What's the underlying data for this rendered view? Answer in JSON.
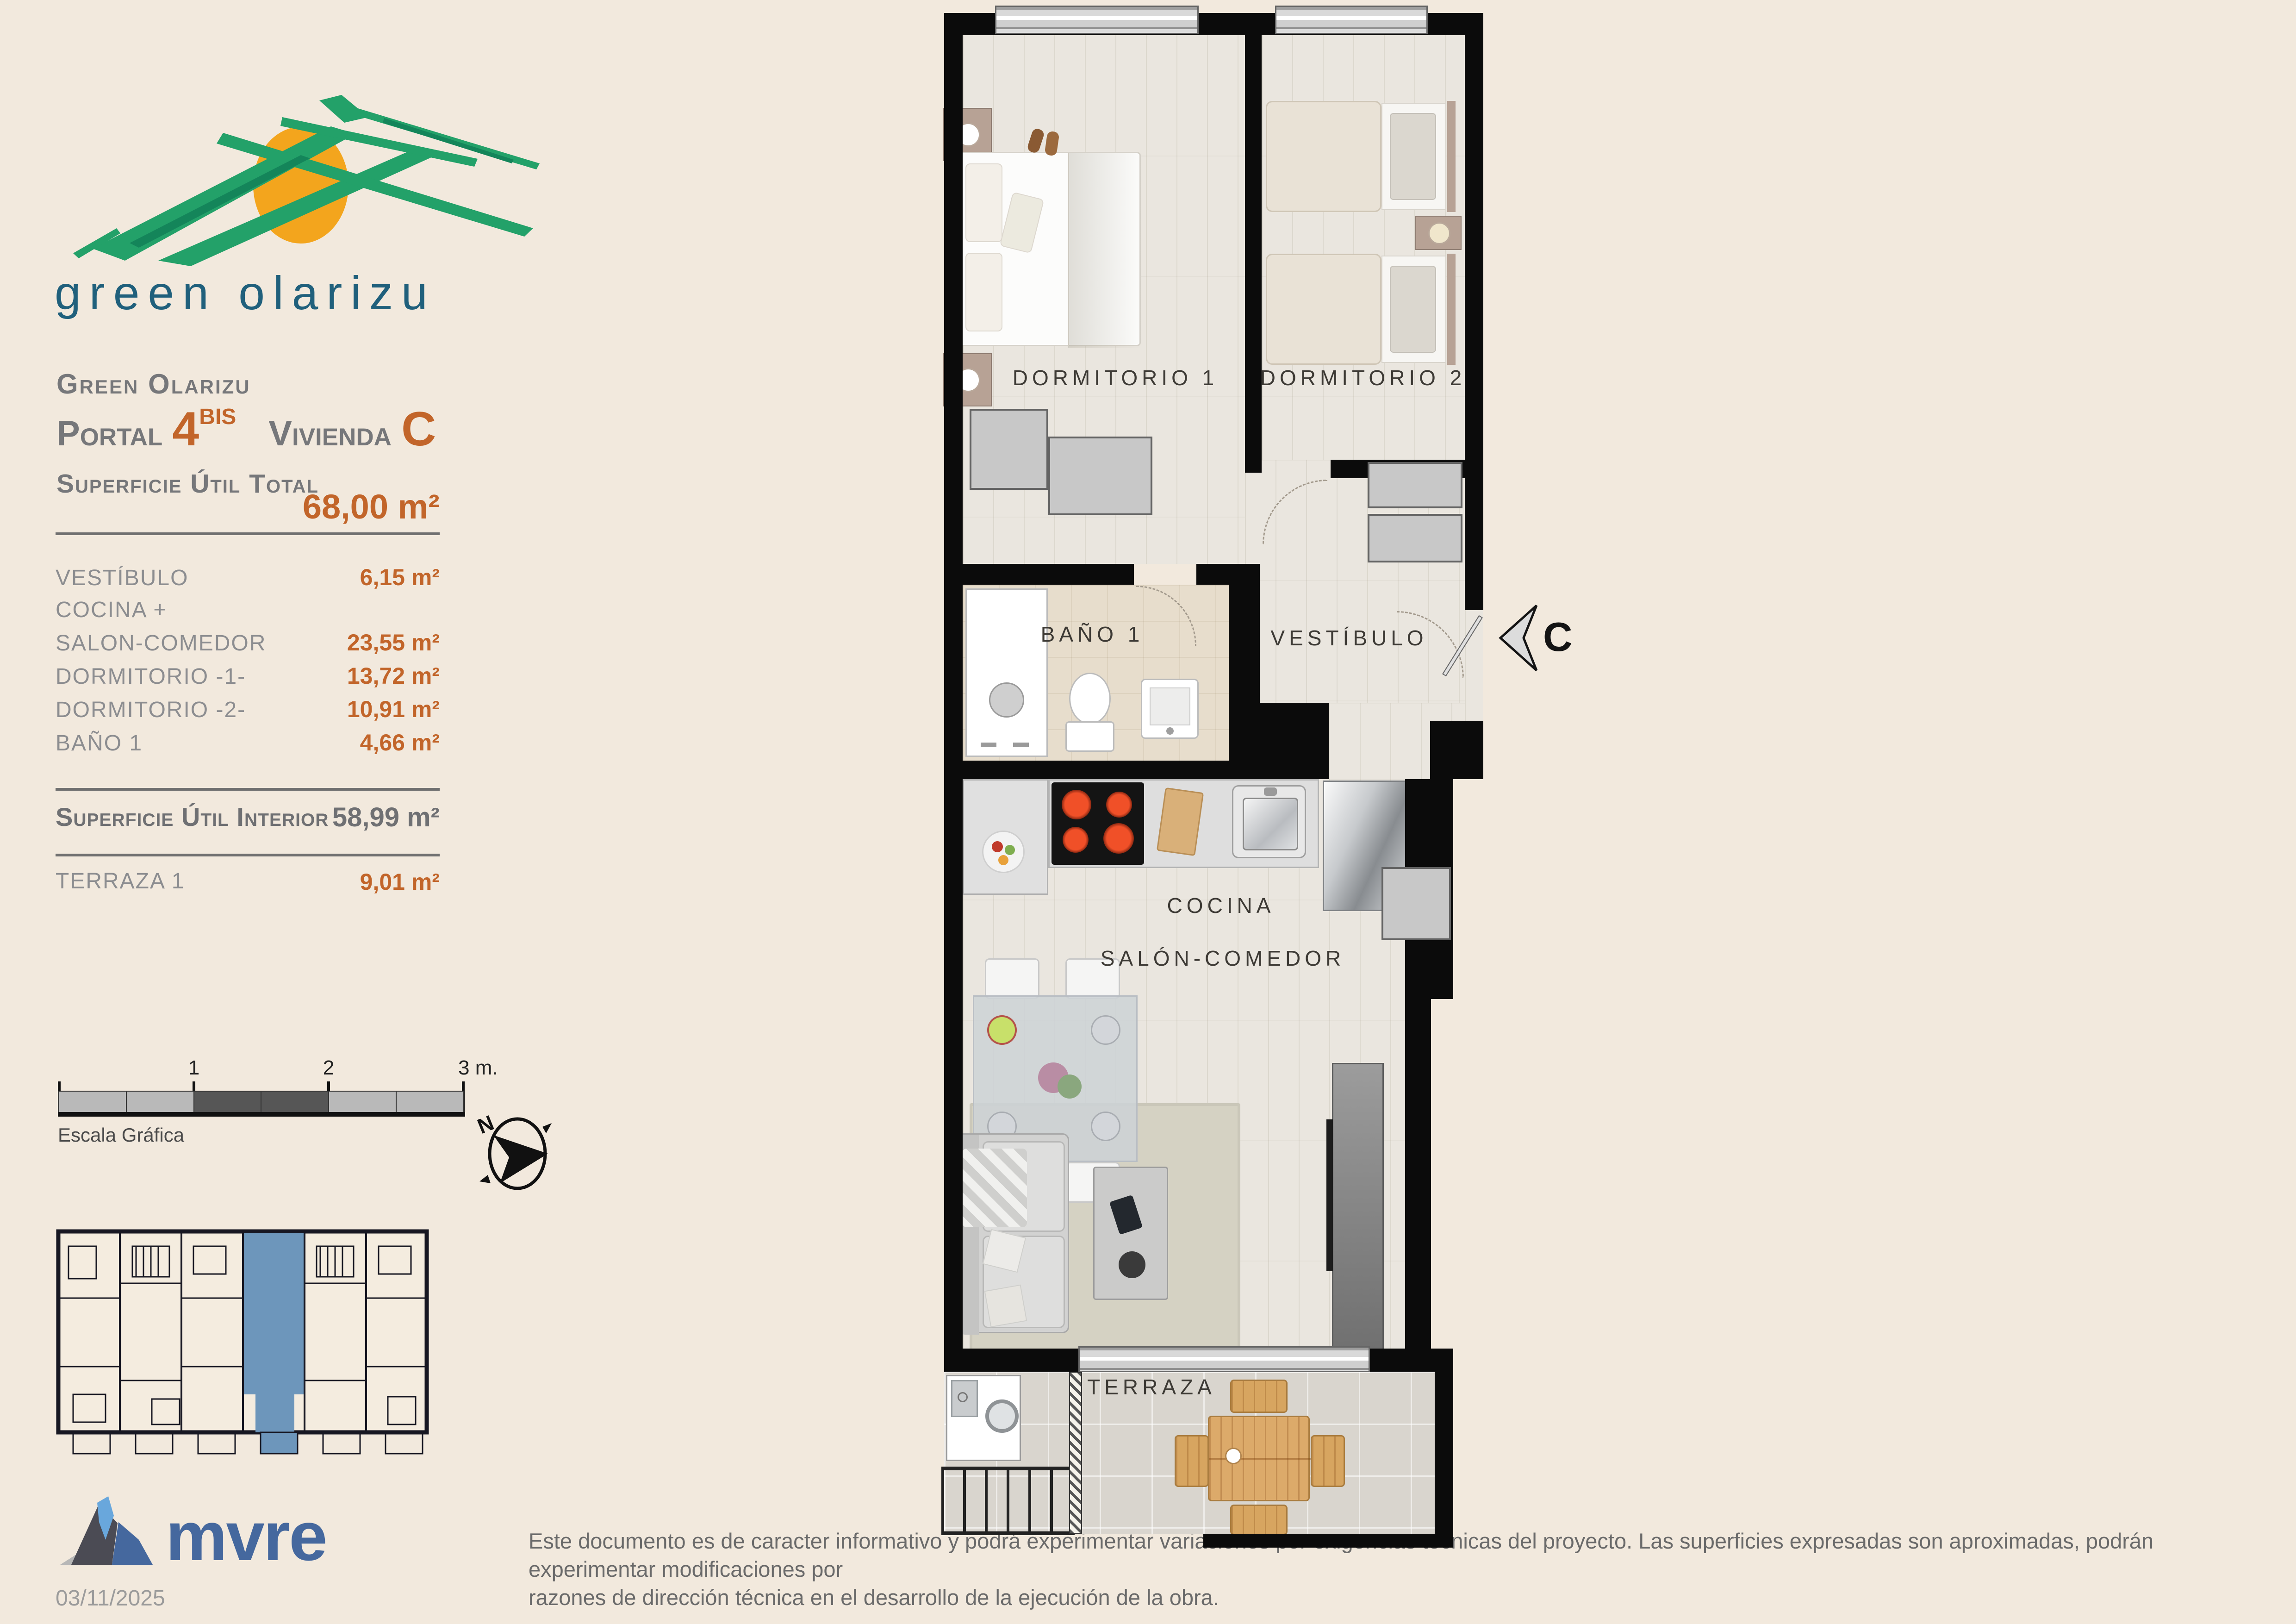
{
  "brand": {
    "logo_text": "green olarizu",
    "company": "mvre",
    "date": "03/11/2025"
  },
  "header": {
    "project": "Green Olarizu",
    "portal_label": "Portal",
    "portal_number": "4",
    "portal_sup": "BIS",
    "vivienda_label": "Vivienda",
    "vivienda_letter": "C"
  },
  "summary": {
    "total_label": "Superficie Útil Total",
    "total_value": "68,00 m²",
    "interior_label": "Superficie Útil Interior",
    "interior_value": "58,99 m²",
    "terrace_label": "TERRAZA 1",
    "terrace_value": "9,01 m²"
  },
  "rooms": [
    {
      "label": "VESTÍBULO",
      "value": "6,15 m²"
    },
    {
      "label": "COCINA +",
      "value": ""
    },
    {
      "label": "SALON-COMEDOR",
      "value": "23,55 m²"
    },
    {
      "label": "DORMITORIO -1-",
      "value": "13,72 m²"
    },
    {
      "label": "DORMITORIO -2-",
      "value": "10,91 m²"
    },
    {
      "label": "BAÑO 1",
      "value": "4,66 m²"
    }
  ],
  "plan": {
    "dorm1": "DORMITORIO 1",
    "dorm2": "DORMITORIO 2",
    "bano": "BAÑO 1",
    "vestibulo": "VESTÍBULO",
    "cocina": "COCINA",
    "salon": "SALÓN-COMEDOR",
    "terraza": "TERRAZA",
    "entrance_letter": "C"
  },
  "scale": {
    "ticks": [
      "1",
      "2",
      "3 m."
    ],
    "caption": "Escala Gráfica"
  },
  "compass": {
    "north": "N"
  },
  "footer": {
    "disclaimer_line1": "Este documento es de caracter informativo y podrá experimentar variaciones por exigencias técnicas del proyecto. Las superficies expresadas son aproximadas, podrán experimentar modificaciones por",
    "disclaimer_line2": "razones de dirección técnica en el desarrollo de la ejecución de la obra."
  },
  "colors": {
    "accent_orange": "#c2652a",
    "heading_gray": "#77787b",
    "logo_teal": "#20607c",
    "highlight_blue": "#6d96bb",
    "mvre_blue": "#45689e",
    "logo_green": "#23a169",
    "logo_sun": "#f3a51d"
  }
}
